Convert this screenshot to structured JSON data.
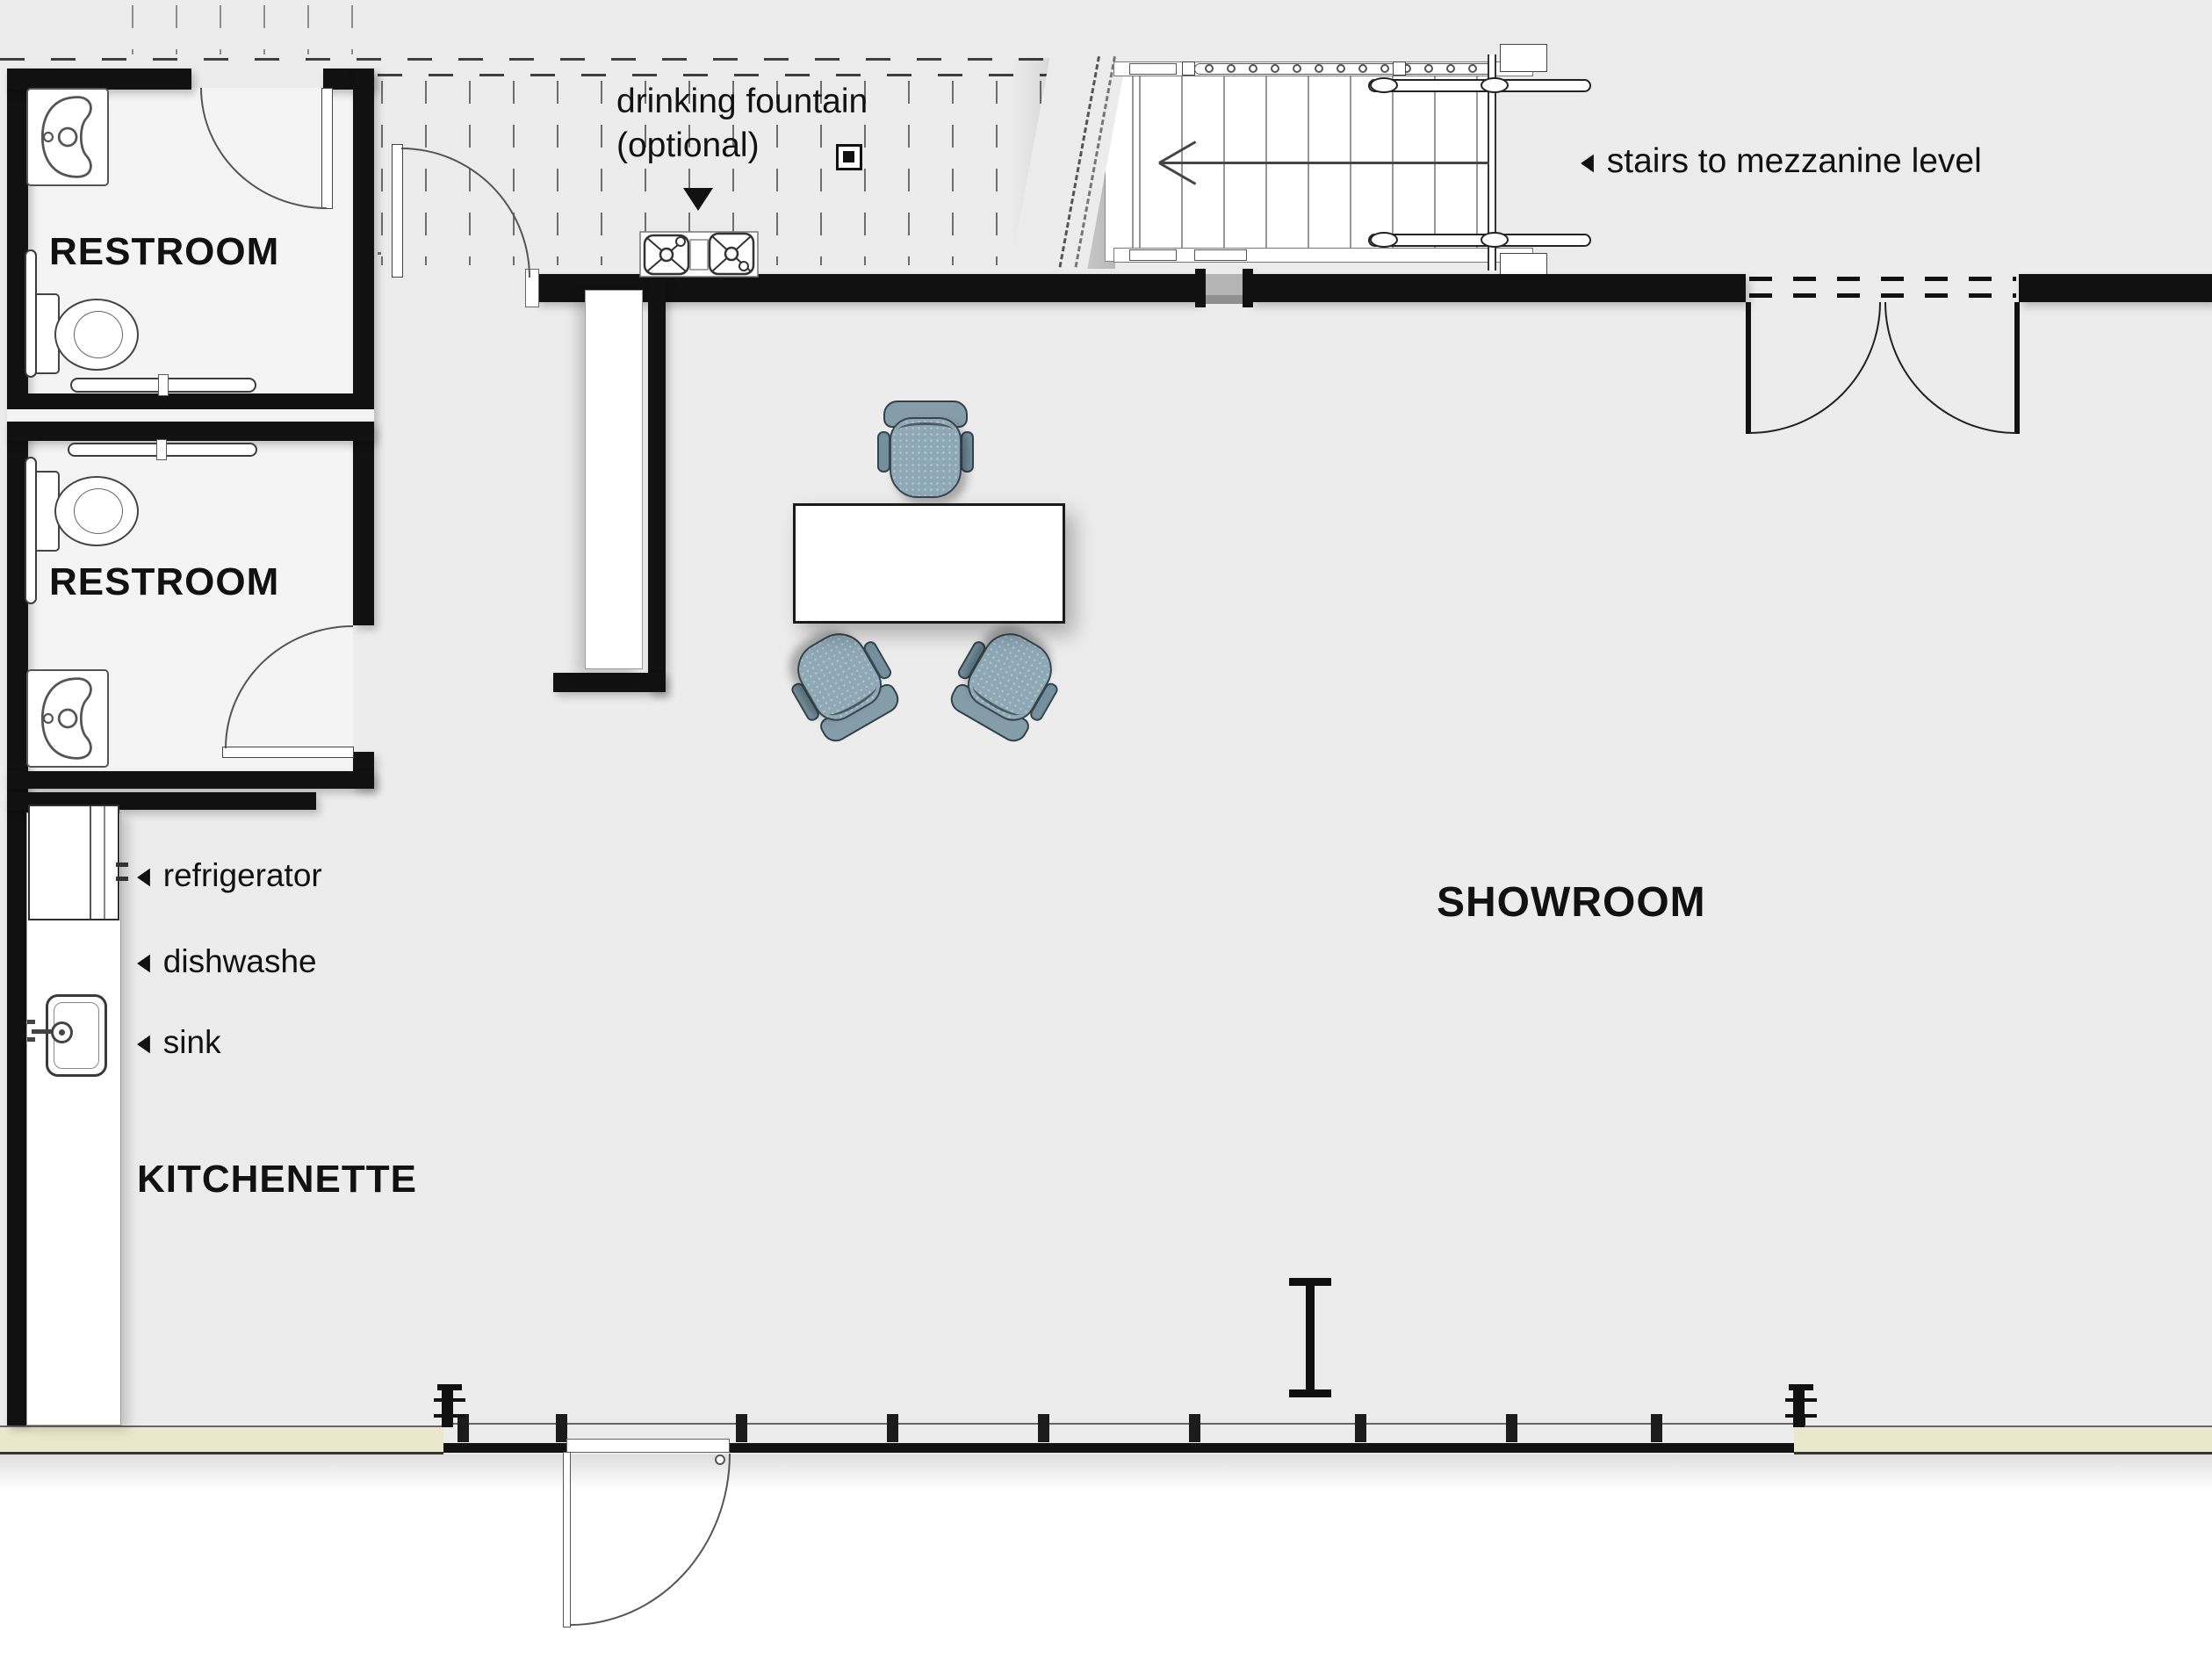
{
  "document": {
    "type": "architectural floor plan"
  },
  "rooms": {
    "restroom_top": {
      "label": "RESTROOM"
    },
    "restroom_bottom": {
      "label": "RESTROOM"
    },
    "kitchenette": {
      "label": "KITCHENETTE"
    },
    "showroom": {
      "label": "SHOWROOM"
    }
  },
  "annotations": {
    "drinking_fountain_line1": "drinking fountain",
    "drinking_fountain_line2": "(optional)",
    "stairs": "stairs to mezzanine level",
    "refrigerator": "refrigerator",
    "dishwasher": "dishwashe",
    "sink": "sink"
  },
  "glyphs": {
    "left_arrow": "◀"
  },
  "colors": {
    "floor": "#ececec",
    "room_floor": "#f4f4f4",
    "wall": "#111111",
    "exterior": "#ffffff",
    "south_wall": "#eae8cc",
    "chair_fill": "#8fa8b6",
    "chair_edge": "#37454d",
    "line": "#555555"
  }
}
